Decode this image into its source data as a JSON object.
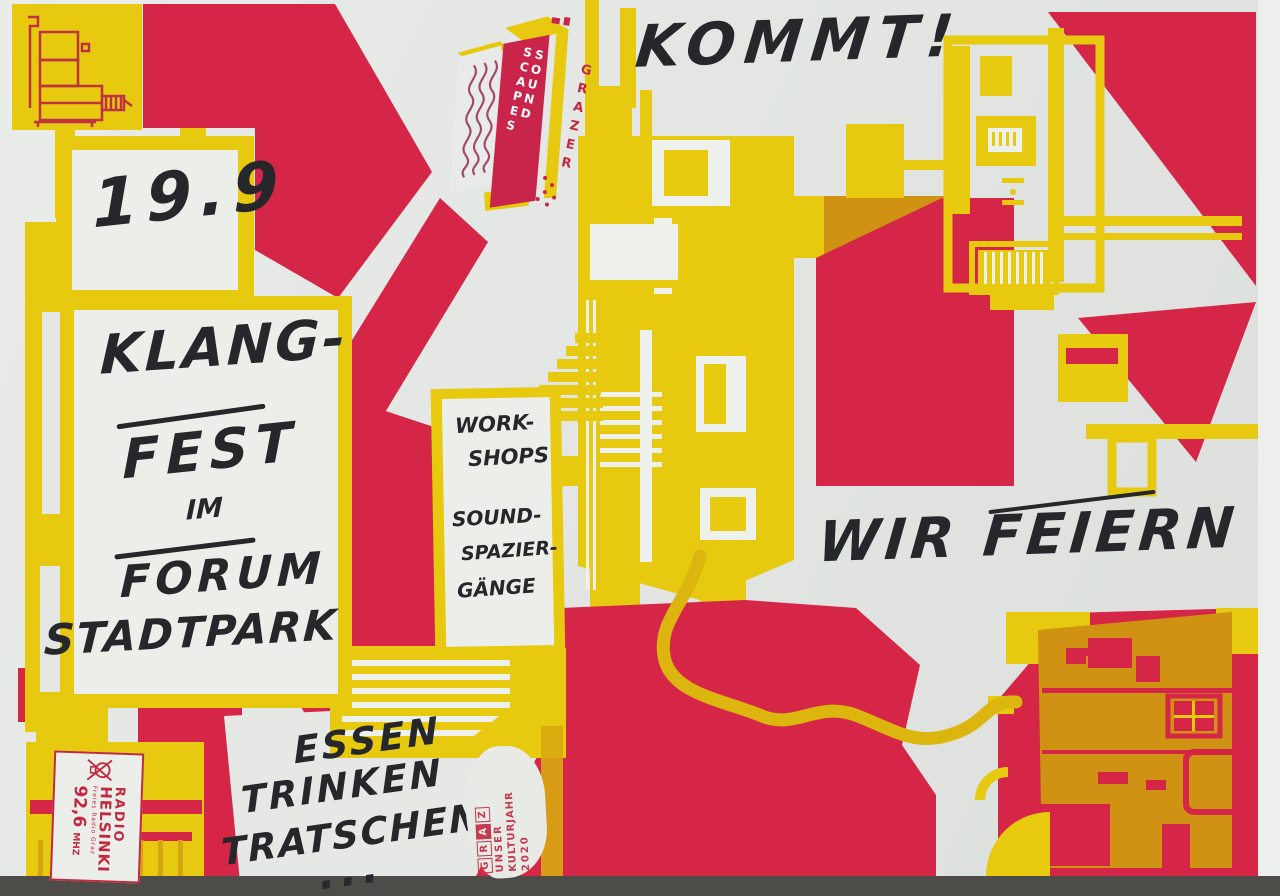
{
  "poster": {
    "kommt": "KOMMT!",
    "date": "19.9",
    "title_lines": [
      "KLANG-",
      "FEST",
      "IM",
      "FORUM",
      "STADTPARK"
    ],
    "workshop_lines": [
      "WORK-",
      "SHOPS",
      "SOUND-",
      "SPAZIER-",
      "GÄNGE"
    ],
    "celebrate": "WIR FEIERN",
    "food_lines": [
      "ESSEN",
      "TRINKEN",
      "TRATSCHEN",
      "..."
    ],
    "logo": {
      "brand": "GRAZER",
      "name": "SOUND SCAPES"
    },
    "radio_stamp": {
      "line1": "RADIO",
      "line2": "HELSINKI",
      "sub": "Freies Radio Graz",
      "freq": "92,6",
      "unit": "MHZ"
    },
    "graz_stamp": {
      "letters": [
        "G",
        "R",
        "A",
        "Z"
      ],
      "line2": "UNSER",
      "line3": "KULTURJAHR",
      "line4": "2020"
    },
    "colors": {
      "red": "#d52647",
      "yellow": "#e7c90f",
      "overprint": "#cf9212",
      "paper": "#e3e6e3",
      "ink": "#25272b"
    }
  }
}
